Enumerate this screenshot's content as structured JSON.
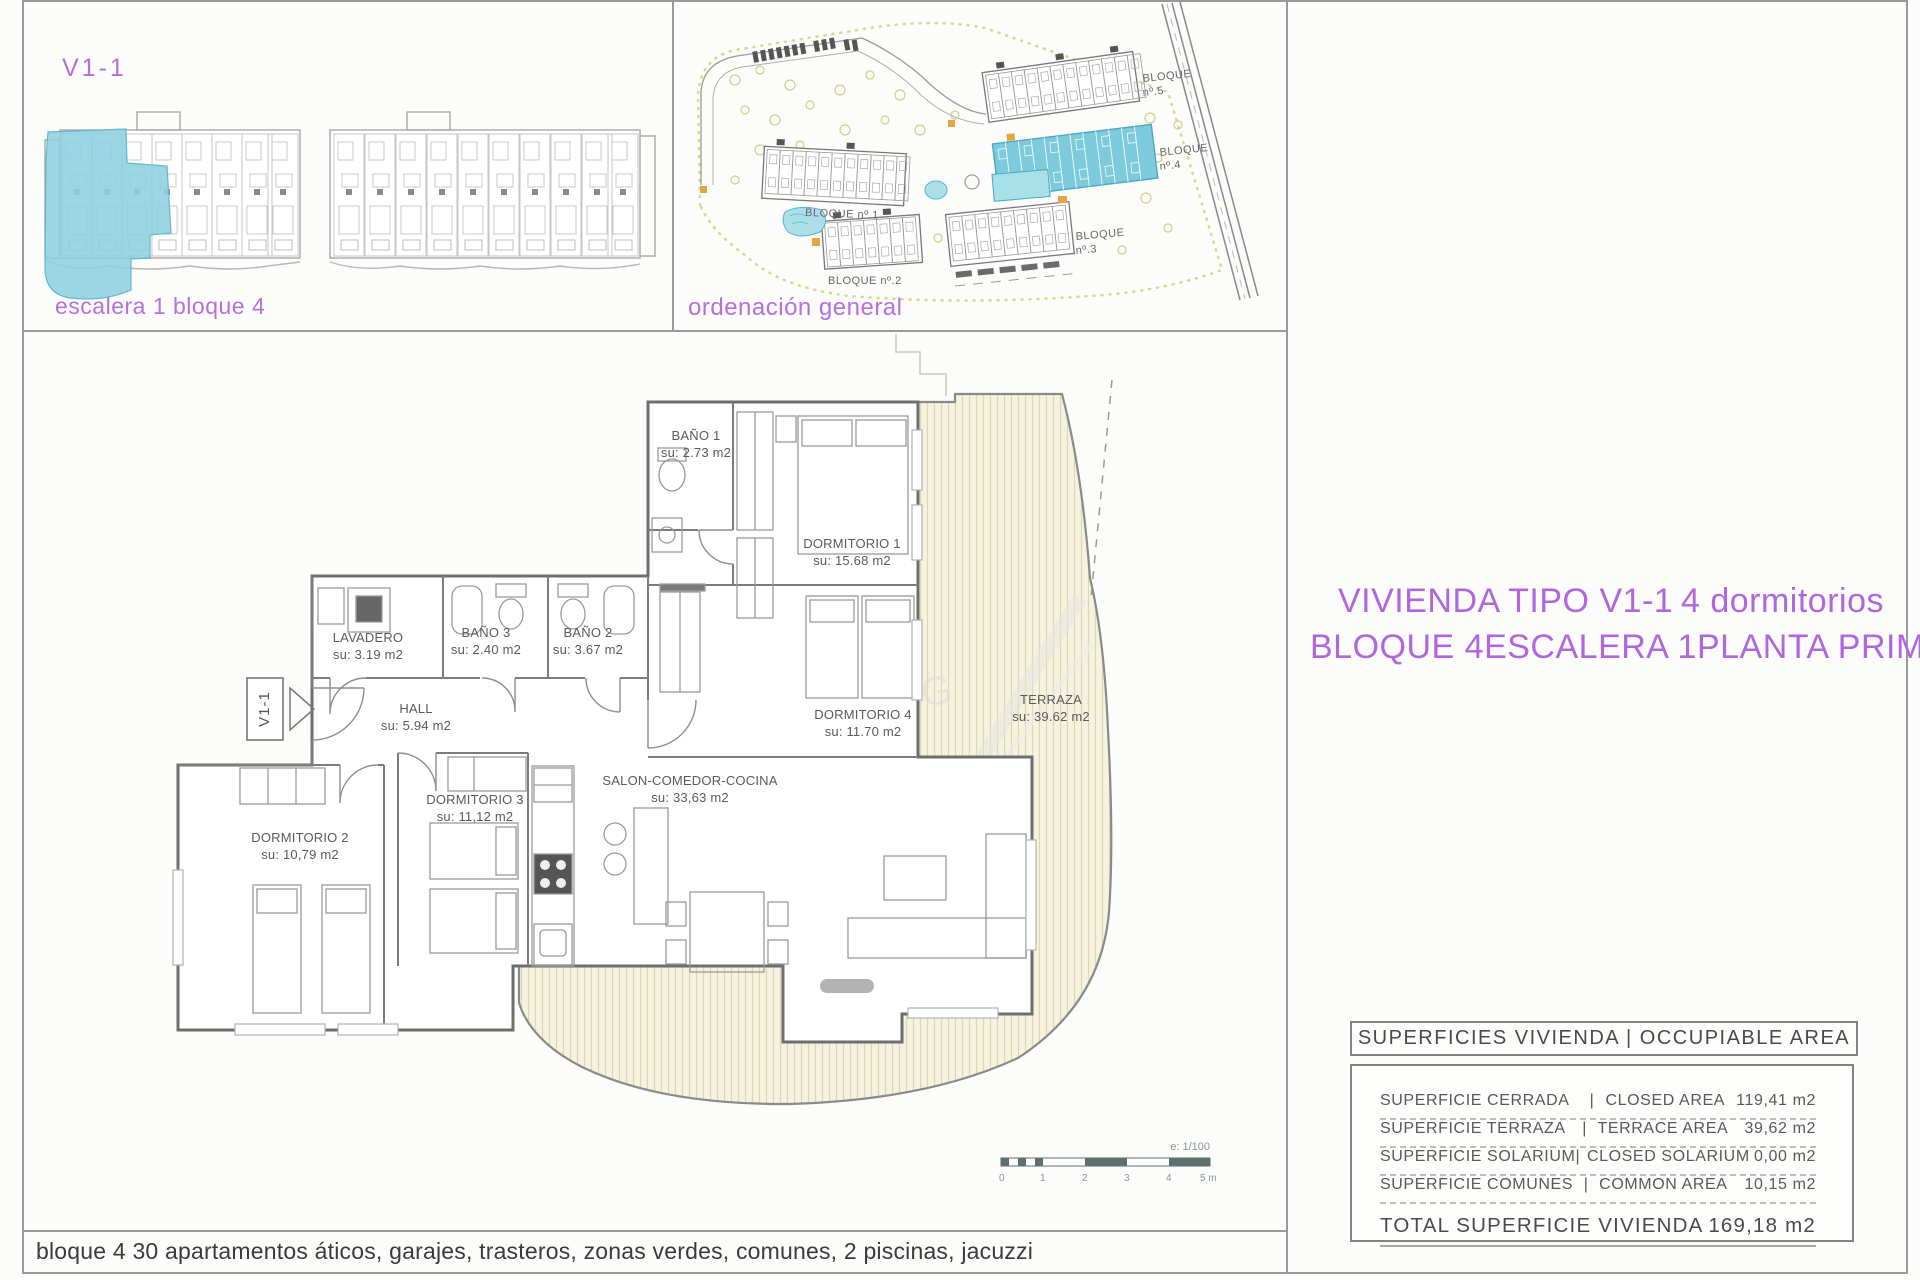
{
  "top_left_panel": {
    "unit_code": "V1-1",
    "caption": "escalera 1 bloque 4"
  },
  "site_panel": {
    "caption": "ordenación general",
    "block_labels": [
      {
        "label": "BLOQUE",
        "num": "nº.5"
      },
      {
        "label": "BLOQUE",
        "num": "nº.4"
      },
      {
        "label": "BLOQUE nº.1"
      },
      {
        "label": "BLOQUE nº.2"
      },
      {
        "label": "BLOQUE",
        "num": "nº.3"
      }
    ]
  },
  "floor_plan": {
    "entry_label": "V1-1",
    "rooms": [
      {
        "name": "BAÑO 1",
        "area": "su: 2.73 m2"
      },
      {
        "name": "DORMITORIO 1",
        "area": "su: 15.68 m2"
      },
      {
        "name": "LAVADERO",
        "area": "su: 3.19 m2"
      },
      {
        "name": "BAÑO 3",
        "area": "su: 2.40 m2"
      },
      {
        "name": "BAÑO 2",
        "area": "su: 3.67 m2"
      },
      {
        "name": "HALL",
        "area": "su: 5.94 m2"
      },
      {
        "name": "DORMITORIO 4",
        "area": "su: 11.70 m2"
      },
      {
        "name": "TERRAZA",
        "area": "su: 39.62 m2"
      },
      {
        "name": "DORMITORIO 2",
        "area": "su: 10,79 m2"
      },
      {
        "name": "DORMITORIO 3",
        "area": "su: 11,12 m2"
      },
      {
        "name": "SALON-COMEDOR-COCINA",
        "area": "su: 33,63 m2"
      }
    ],
    "scale_note": "e: 1/100",
    "scale_ticks": [
      "0",
      "1",
      "2",
      "3",
      "4",
      "5 m"
    ]
  },
  "title": {
    "line1_left": "VIVIENDA TIPO V1-1",
    "line1_right": "4 dormitorios",
    "line2_parts": [
      "BLOQUE 4",
      "ESCALERA 1",
      "PLANTA PRIMERA"
    ]
  },
  "areas_table": {
    "header": "SUPERFICIES VIVIENDA | OCCUPIABLE AREA",
    "rows": [
      {
        "es": "SUPERFICIE CERRADA",
        "en": "CLOSED AREA",
        "value": "119,41 m2"
      },
      {
        "es": "SUPERFICIE TERRAZA",
        "en": "TERRACE AREA",
        "value": "39,62 m2"
      },
      {
        "es": "SUPERFICIE SOLARIUM",
        "en": "CLOSED SOLARIUM",
        "value": "0,00 m2"
      },
      {
        "es": "SUPERFICIE COMUNES",
        "en": "COMMON AREA",
        "value": "10,15 m2"
      }
    ],
    "total_label": "TOTAL SUPERFICIE VIVIENDA",
    "total_value": "169,18 m2"
  },
  "page": {
    "bottom_caption": "bloque 4 30 apartamentos áticos, garajes, trasteros, zonas verdes, comunes, 2 piscinas, jacuzzi"
  },
  "colors": {
    "accent_magenta": "#b66fe0",
    "highlight_blue": "#8ecfdf",
    "site_block_blue": "#7ccadb",
    "terrace_fill": "#f5f2df",
    "terrace_hatch": "#ddd7b2",
    "line_gray": "#6e6e6e"
  }
}
